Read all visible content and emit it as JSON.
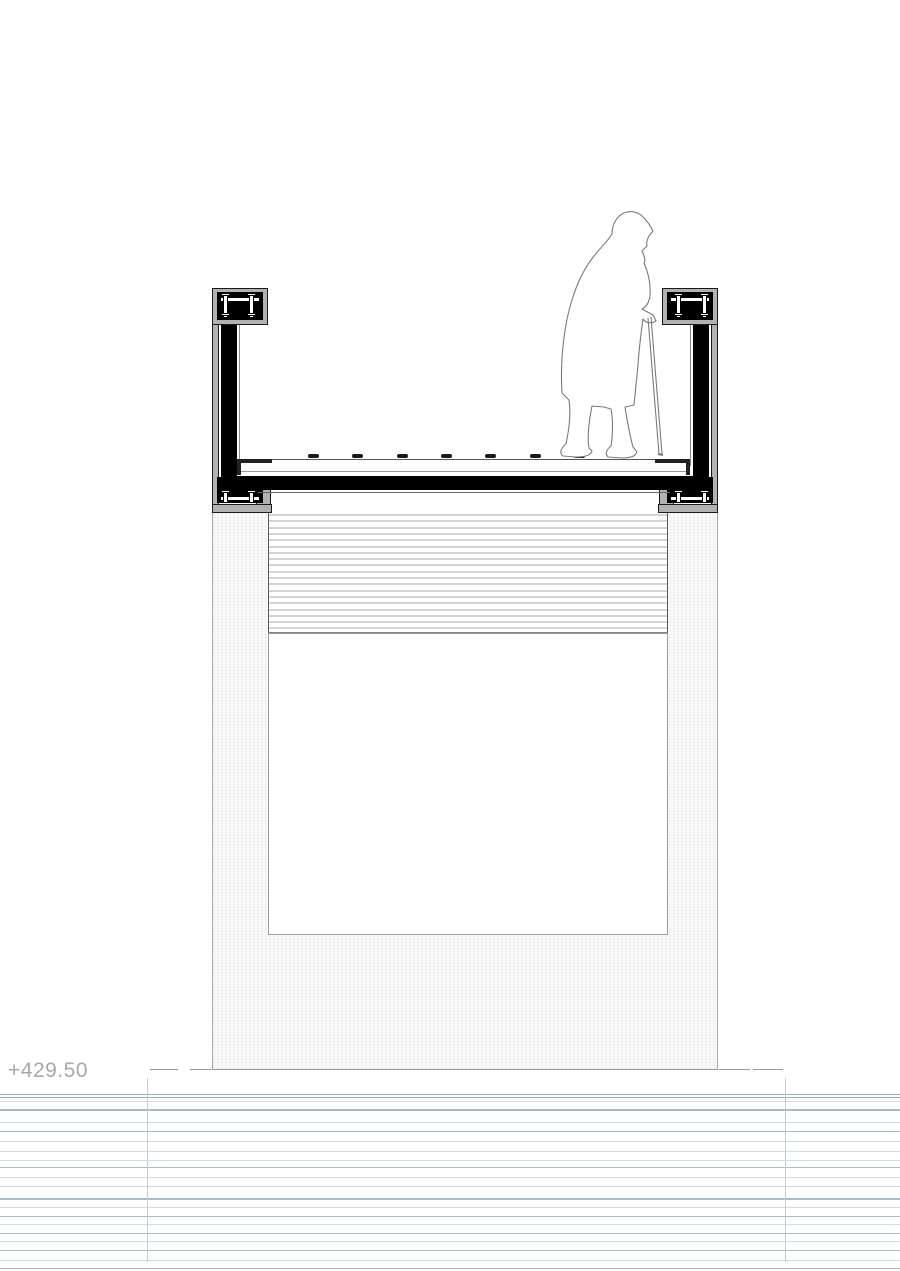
{
  "document": {
    "type": "architectural-section-drawing",
    "background": "#ffffff",
    "width": 900,
    "height": 1271
  },
  "annotation": {
    "elevation_label": "+429.50",
    "color": "#a8a8a8"
  },
  "figure": {
    "name": "elderly-person-with-cane",
    "stroke": "#7a7a7a",
    "fill": "#ffffff"
  },
  "drawing": {
    "colors": {
      "parapet_gray": "#b2b2b2",
      "core_black": "#000000",
      "louver_line": "#d4d4d4",
      "stipple_dot": "#dedede",
      "edge_gray": "#999999",
      "clip_dark": "#1a1a1a",
      "water_dark": "#9aadb8",
      "water_mid": "#a9bbc4",
      "water_light": "#d2dbe0",
      "leader_gray": "#c2ccd1"
    },
    "deck_clips": {
      "count": 8,
      "y": 454,
      "first_x": 308,
      "spacing": 44.3,
      "width": 11,
      "height": 4
    },
    "louvers": {
      "count": 19,
      "x": 268,
      "width": 400,
      "start_y": 514,
      "spacing": 6.3,
      "line_height": 2
    },
    "water_lines": [
      {
        "y": 1094,
        "h": 1,
        "tone": "dark"
      },
      {
        "y": 1097,
        "h": 1,
        "tone": "dark"
      },
      {
        "y": 1101,
        "h": 1,
        "tone": "light"
      },
      {
        "y": 1109,
        "h": 2,
        "tone": "mid"
      },
      {
        "y": 1122,
        "h": 1,
        "tone": "light"
      },
      {
        "y": 1131,
        "h": 1,
        "tone": "mid"
      },
      {
        "y": 1141,
        "h": 1,
        "tone": "light"
      },
      {
        "y": 1151,
        "h": 1,
        "tone": "light"
      },
      {
        "y": 1160,
        "h": 1,
        "tone": "light"
      },
      {
        "y": 1167,
        "h": 1,
        "tone": "mid"
      },
      {
        "y": 1177,
        "h": 1,
        "tone": "light"
      },
      {
        "y": 1186,
        "h": 1,
        "tone": "light"
      },
      {
        "y": 1198,
        "h": 2,
        "tone": "mid"
      },
      {
        "y": 1207,
        "h": 1,
        "tone": "light"
      },
      {
        "y": 1216,
        "h": 1,
        "tone": "mid"
      },
      {
        "y": 1224,
        "h": 1,
        "tone": "light"
      },
      {
        "y": 1233,
        "h": 1,
        "tone": "mid"
      },
      {
        "y": 1241,
        "h": 1,
        "tone": "light"
      },
      {
        "y": 1250,
        "h": 1,
        "tone": "mid"
      },
      {
        "y": 1260,
        "h": 1,
        "tone": "light"
      },
      {
        "y": 1268,
        "h": 1,
        "tone": "mid"
      }
    ],
    "leader_lines": [
      {
        "x": 147,
        "y": 1078,
        "h": 184
      },
      {
        "x": 785,
        "y": 1078,
        "h": 184
      }
    ],
    "ground_dashes": [
      {
        "x": 150,
        "w": 28
      },
      {
        "x": 190,
        "w": 21
      },
      {
        "x": 719,
        "w": 31
      },
      {
        "x": 753,
        "w": 30
      }
    ]
  }
}
